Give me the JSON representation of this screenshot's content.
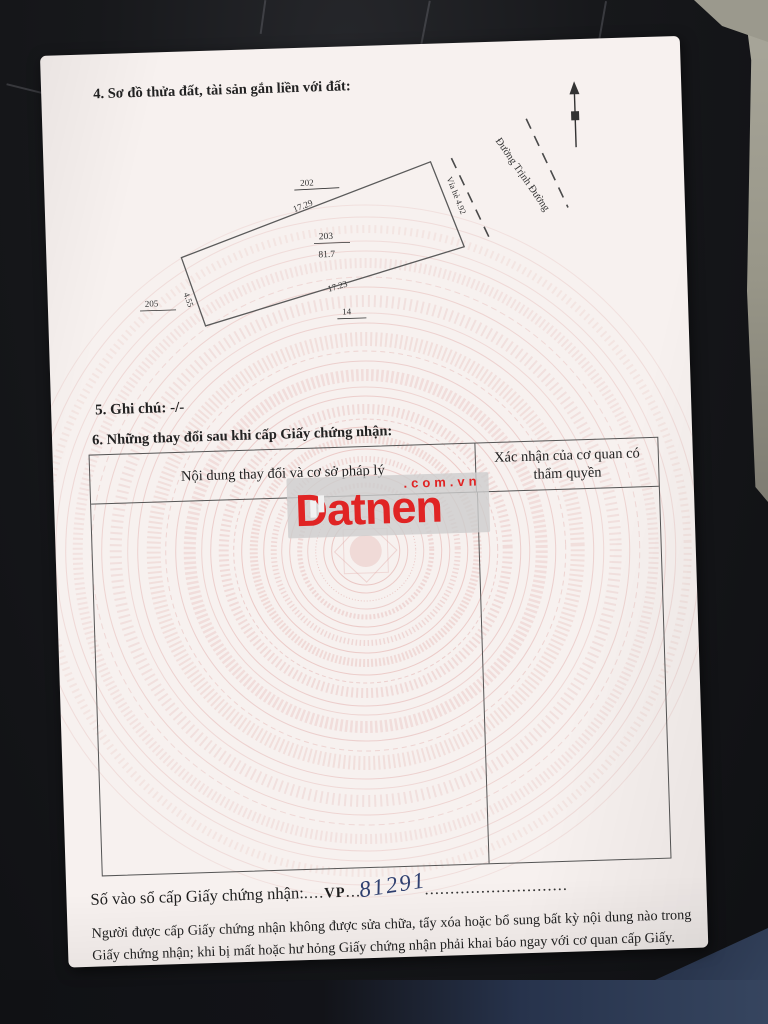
{
  "sections": {
    "s4_title": "4. Sơ đồ thửa đất, tài sản gắn liền với đất:",
    "s5_note": "5. Ghi chú: -/-",
    "s6_title": "6. Những thay đổi sau khi cấp Giấy chứng nhận:"
  },
  "diagram": {
    "adjacent_plot_top": "202",
    "edge_top_length": "17.29",
    "plot_number": "203",
    "plot_area": "81.7",
    "edge_bottom_length": "17.23",
    "adjacent_plot_bottom": "14",
    "adjacent_plot_left": "205",
    "edge_left_length": "4.55",
    "edge_right_label": "Vỉa hè  4.92",
    "road_name": "Đường Trịnh Đường"
  },
  "changes_table": {
    "columns": [
      "Nội dung thay đổi và cơ sở pháp lý",
      "Xác nhận của cơ quan có thẩm quyền"
    ]
  },
  "watermark": {
    "brand": "Datnen",
    "suffix": ".com.vn",
    "red": "#e02424"
  },
  "registry": {
    "label": "Số vào sổ cấp Giấy chứng nhận:",
    "dots_a": "....",
    "prefix": "VP",
    "dots_b": "...",
    "number": "81291",
    "dots_c": "............................",
    "ink_blue": "#2f4070"
  },
  "notice": "Người được cấp Giấy chứng nhận không được sửa chữa, tẩy xóa hoặc bổ sung bất kỳ nội dung nào trong Giấy chứng nhận; khi bị mất hoặc hư hỏng Giấy chứng nhận phải khai báo ngay với cơ quan cấp Giấy."
}
